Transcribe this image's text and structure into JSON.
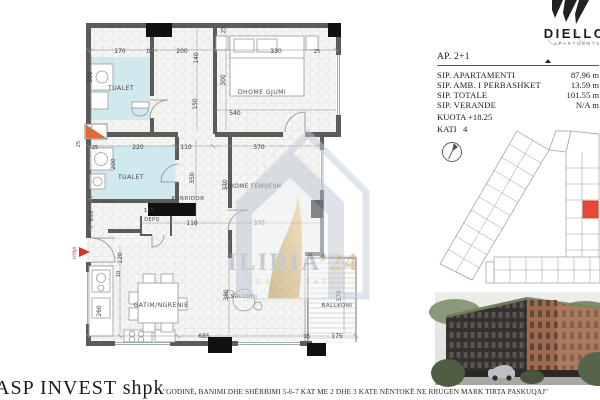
{
  "brand": {
    "name": "DIELLON",
    "tagline": "APARTMENTS 2"
  },
  "panel": {
    "ap_code": "AP. 2+1",
    "specs": [
      {
        "label": "SIP. APARTAMENTI",
        "value": "87.96 m"
      },
      {
        "label": "SIP. AMB. I PERBASHKET",
        "value": "13.59 m"
      },
      {
        "label": "SIP. TOTALE",
        "value": "101.55 m"
      },
      {
        "label": "SIP. VERANDE",
        "value": "N/A m"
      }
    ],
    "kuota": "KUOTA +18.25",
    "kati": "KATI   4"
  },
  "watermark": {
    "name": "ILIRIA",
    "suffix": "’24",
    "tagline": "REAL ESTATE"
  },
  "sheet": {
    "developer": "ASP INVEST shpk",
    "caption": "\"GODINË, BANIMI DHE SHËRBIMI 5-6-7 KAT ME 2 DHE 3 KATE NËNTOKË NE RRUGEN MARK TIRTA PASKUQAJ\""
  },
  "floorplan": {
    "rooms": [
      "TUALET",
      "DHOME GJUMI",
      "TUALET",
      "KORRIDOR",
      "DHOME FEMIJESH",
      "DEPO",
      "GATIM/NGRENIE",
      "SALLONI",
      "BALLKONI",
      "HYRJA"
    ],
    "dims": [
      "170",
      "10",
      "200",
      "330",
      "25",
      "25",
      "140",
      "150",
      "300",
      "300",
      "540",
      "25",
      "220",
      "110",
      "370",
      "200",
      "350",
      "370",
      "910",
      "115",
      "110",
      "370",
      "260",
      "120",
      "10",
      "685",
      "380",
      "370",
      "25",
      "175",
      "25"
    ]
  },
  "colors": {
    "wall": "#5b5b5b",
    "bathroom_floor": "#cfe9ef",
    "accent_red": "#e8483a",
    "shaft_orange": "#e8662a",
    "watermark_slate": "#b9c3d4",
    "watermark_gold": "#c9a967"
  }
}
